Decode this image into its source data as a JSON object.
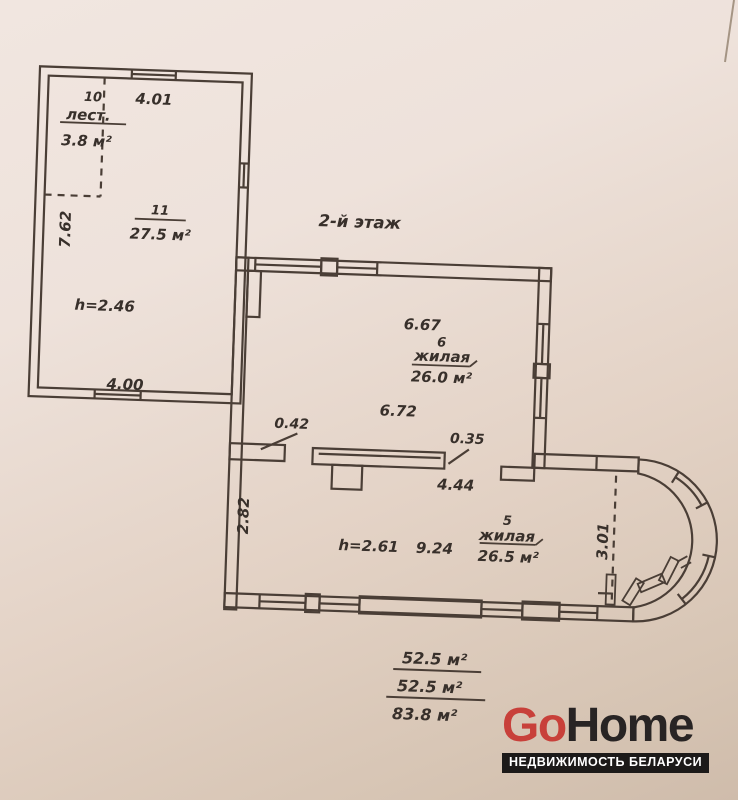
{
  "plan": {
    "floor_label": "2-й этаж",
    "rooms": {
      "stairs": {
        "number": "10",
        "label": "лест.",
        "area": "3.8 м²"
      },
      "r11": {
        "number": "11",
        "area": "27.5 м²"
      },
      "r6": {
        "number": "6",
        "label": "жилая",
        "area": "26.0 м²"
      },
      "r5": {
        "number": "5",
        "label": "жилая",
        "area": "26.5 м²"
      }
    },
    "dims": {
      "annex_width_top": "4.01",
      "annex_depth_left": "7.62",
      "annex_ceiling": "h=2.46",
      "annex_width_bottom": "4.00",
      "r6_width": "6.67",
      "r6_width_inner": "6.72",
      "part_stub": "0.42",
      "part_thickness": "0.35",
      "part_length": "4.44",
      "r5_depth": "2.82",
      "r5_ceiling": "h=2.61",
      "r5_width": "9.24",
      "bay_depth": "3.01"
    },
    "totals": [
      "52.5 м²",
      "52.5 м²",
      "83.8 м²"
    ]
  },
  "logo": {
    "go": "Go",
    "home": "Home",
    "tagline": "НЕДВИЖИМОСТЬ БЕЛАРУСИ"
  },
  "colors": {
    "ink": "#4a3e36",
    "text": "#38302b",
    "logo_red": "#c8403a",
    "logo_dark": "#282424",
    "band_bg": "#1c1a19",
    "paper": "#ecdfd8"
  }
}
